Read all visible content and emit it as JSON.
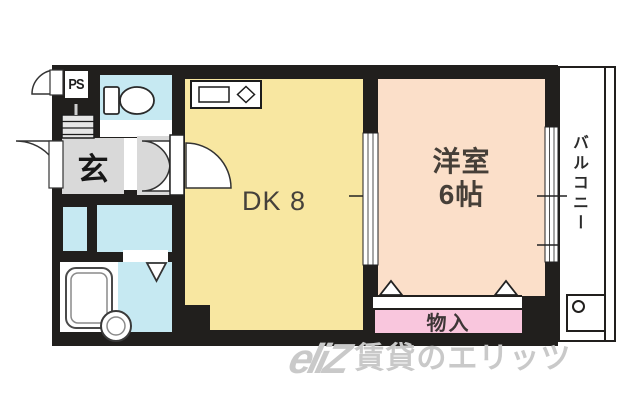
{
  "floorplan": {
    "rooms": {
      "dk": {
        "label": "DK 8",
        "color": "#f8e7a1"
      },
      "western": {
        "name": "洋室",
        "size": "6帖",
        "color": "#fbdfc9"
      },
      "entrance": {
        "label": "玄",
        "color": "#d9d9d9"
      },
      "pipe_space": {
        "label": "PS"
      },
      "storage": {
        "label": "物入",
        "color": "#f9c6dd"
      },
      "balcony": {
        "label": "バルコニー"
      },
      "wet_area_color": "#c6e9f2",
      "wall_color": "#211f1d"
    },
    "icons": [
      "kitchen-counter-icon",
      "toilet-icon",
      "bathtub-icon",
      "washbasin-icon",
      "door-swing-icon",
      "sliding-door-icon",
      "window-icon",
      "closet-door-triangle-icon",
      "washer-pan-icon",
      "shoe-cabinet-icon"
    ],
    "watermark": {
      "logo_text": "eliZ",
      "text": "賃貸のエリッツ",
      "color": "#c9c9c9"
    }
  }
}
